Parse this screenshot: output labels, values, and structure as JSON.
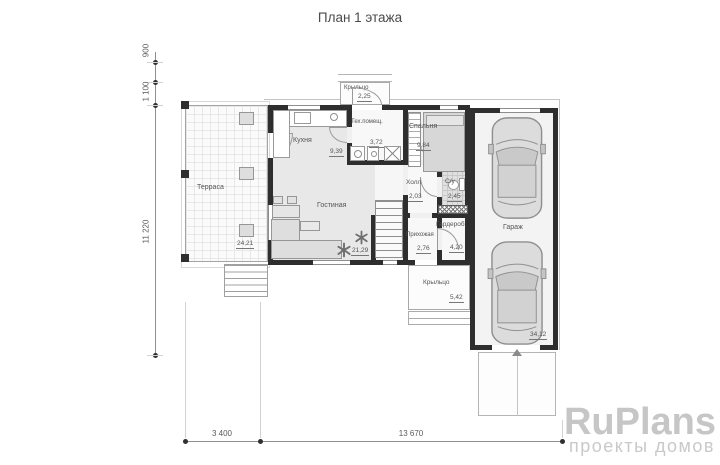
{
  "title": "План 1 этажа",
  "rooms": [
    {
      "id": "terrace",
      "name": "Терраса",
      "area": "24,21"
    },
    {
      "id": "kitchen",
      "name": "Кухня",
      "area": "9,39"
    },
    {
      "id": "tech",
      "name": "Тех.помещ.",
      "area": "3,72"
    },
    {
      "id": "bedroom",
      "name": "Спальня",
      "area": "9,84"
    },
    {
      "id": "porch-top",
      "name": "Крыльцо",
      "area": "2,25"
    },
    {
      "id": "hall",
      "name": "Холл",
      "area": "2,03"
    },
    {
      "id": "bathroom",
      "name": "С/у",
      "area": "2,45"
    },
    {
      "id": "living",
      "name": "Гостиная",
      "area": "21,29"
    },
    {
      "id": "entry",
      "name": "Прихожая",
      "area": "2,76"
    },
    {
      "id": "wardrobe",
      "name": "Гардероб",
      "area": "4,20"
    },
    {
      "id": "garage",
      "name": "Гараж",
      "area": "34,12"
    },
    {
      "id": "porch-bottom",
      "name": "Крыльцо",
      "area": "5,42"
    }
  ],
  "dimensions": {
    "left": [
      "900",
      "1 100",
      "11 220"
    ],
    "bottom": [
      "3 400",
      "13 670"
    ]
  },
  "watermark": {
    "brand": "RuPlans",
    "tagline": "проекты домов"
  },
  "colors": {
    "wall": "#2e2e2e",
    "label_text": "#555555",
    "dimension_text": "#5a5a5a",
    "watermark": "#c6c6c6"
  }
}
